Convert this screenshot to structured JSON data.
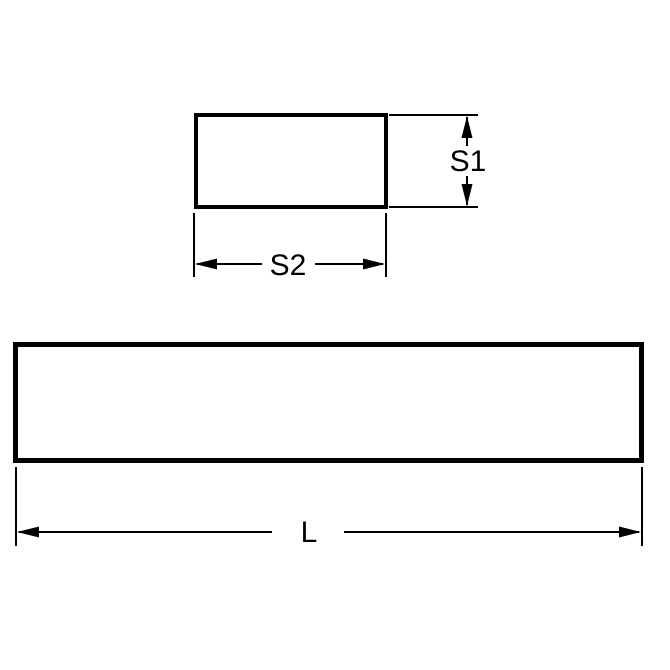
{
  "page": {
    "background_color": "#ffffff",
    "line_color": "#000000"
  },
  "diagram": {
    "kind": "dimensioned-technical-drawing",
    "views": {
      "cross_section": {
        "height_label": "S1",
        "width_label": "S2"
      },
      "side": {
        "length_label": "L"
      }
    }
  }
}
